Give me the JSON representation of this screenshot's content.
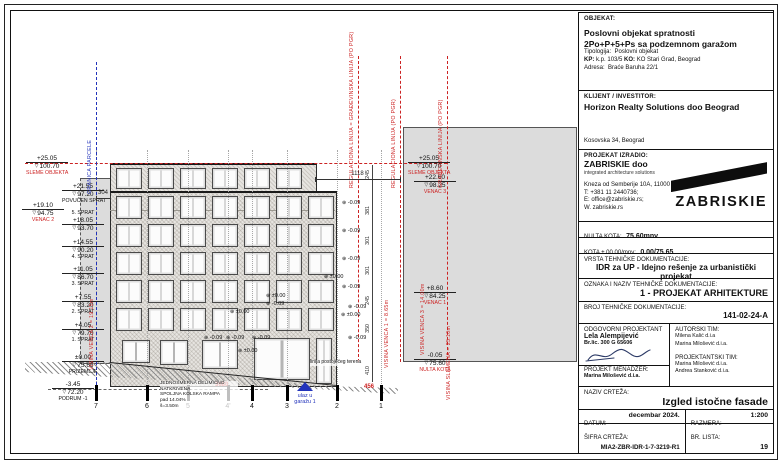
{
  "titleblock": {
    "objekat_label": "OBJEKAT:",
    "objekat_line1": "Poslovni objekat spratnosti",
    "objekat_line2": "2Po+P+5+Ps sa podzemnom garažom",
    "tipologija_label": "Tipologija:",
    "tipologija": "Poslovni objekat",
    "kp_label": "KP:",
    "kp": "k.p. 103/5",
    "ko_label": "KO:",
    "ko": "KO Stari Grad, Beograd",
    "adresa_label": "Adresa:",
    "adresa": "Braće Baruha 22/1",
    "klijent_label": "KLIJENT / INVESTITOR:",
    "klijent_name": "Horizon Realty Solutions doo Beograd",
    "klijent_adresa": "Kosovska 34, Beograd",
    "izradio_label": "PROJEKAT IZRADIO:",
    "izradio_name": "ZABRISKIE doo",
    "izradio_tagline": "integrated architecture solutions",
    "izradio_adresa": "Kneza od Semberije 10A, 11000 Beograd",
    "izradio_tel": "T: +381 11 2440736;",
    "izradio_email": "E: office@zabriskie.rs;",
    "izradio_web": "W. zabriskie.rs",
    "logo_text": "ZABRISKIE",
    "nulta_kota_label": "NULTA KOTA:",
    "nulta_kota": "75.60mnv",
    "kota_label": "KOTA ± 00.00/mnv:",
    "kota": "0.00/75.65",
    "vrsta_label": "VRSTA TEHNIČKE DOKUMENTACIJE:",
    "vrsta": "IDR za UP - Idejno rešenje za urbanistički projekat",
    "oznaka_label": "OZNAKA I NAZIV TEHNIČKE DOKUMENTACIJE:",
    "oznaka": "1 - PROJEKAT ARHITEKTURE",
    "broj_label": "BROJ TEHNIČKE DOKUMENTACIJE:",
    "broj": "141-02-24-A",
    "odgovorni_label": "ODGOVORNI PROJEKTANT",
    "odgovorni_name": "Lela Alempijević",
    "odgovorni_lic": "Br.lic. 300 G 65606",
    "menadzer_label": "PROJEKT MENADŽER:",
    "menadzer_name": "Marina Milošević d.i.a.",
    "autorski_label": "AUTORSKI TIM:",
    "autorski": [
      "Milena Kalić d.i.a",
      "Marina Milošević d.i.a."
    ],
    "projektantski_label": "PROJEKTANTSKI TIM:",
    "projektantski": [
      "Marina Milošević d.i.a.",
      "Andrea Stanković d.i.a."
    ],
    "naziv_label": "NAZIV CRTEŽA:",
    "naziv": "Izgled istočne fasade",
    "datum_label": "DATUM:",
    "datum": "decembar 2024.",
    "razmera_label": "RAZMERA:",
    "razmera": "1:200",
    "sifra_label": "ŠIFRA CRTEŽA:",
    "sifra": "MIA2-ZBR-IDR-1-7-3219-R1",
    "lista_label": "BR. LISTA:",
    "lista": "19"
  },
  "drawing": {
    "colors": {
      "red": "#cc2222",
      "blue": "#2233bb"
    },
    "markers": [
      {
        "elev": "+25.05",
        "kota": "100.70",
        "label": "SLEME OBJEKTA",
        "red": true,
        "x": 16,
        "y": 153
      },
      {
        "elev": "+21.55",
        "kota": "97.20",
        "label": "POVUČEN SPRAT",
        "red": false,
        "x": 52,
        "y": 181
      },
      {
        "elev": "+19.10",
        "kota": "94.75",
        "label": "VENAC 2",
        "red": true,
        "x": 12,
        "y": 200
      },
      {
        "elev": "+18.05",
        "kota": "93.70",
        "label": "5. SPRAT",
        "red": false,
        "x": 52,
        "y": 209,
        "labelTop": true
      },
      {
        "elev": "+14.55",
        "kota": "90.20",
        "label": "4. SPRAT",
        "red": false,
        "x": 52,
        "y": 237
      },
      {
        "elev": "+11.05",
        "kota": "86.70",
        "label": "3. SPRAT",
        "red": false,
        "x": 52,
        "y": 264
      },
      {
        "elev": "+7.55",
        "kota": "83.20",
        "label": "2. SPRAT",
        "red": false,
        "x": 52,
        "y": 292
      },
      {
        "elev": "+4.05",
        "kota": "79.70",
        "label": "1. SPRAT",
        "red": false,
        "x": 52,
        "y": 320
      },
      {
        "elev": "±0.00",
        "kota": "75.65",
        "label": "PRIZEMLJE",
        "red": false,
        "x": 52,
        "y": 352
      },
      {
        "elev": "-3.45",
        "kota": "72.20",
        "label": "PODRUM -1",
        "red": false,
        "x": 42,
        "y": 379
      },
      {
        "elev": "+25.05",
        "kota": "100.70",
        "label": "SLEME OBJEKTA",
        "red": true,
        "x": 398,
        "y": 153
      },
      {
        "elev": "+22.60",
        "kota": "98.25",
        "label": "VENAC 3",
        "red": true,
        "x": 404,
        "y": 172
      },
      {
        "elev": "+8.60",
        "kota": "84.25",
        "label": "VENAC 1",
        "red": true,
        "x": 404,
        "y": 283
      },
      {
        "elev": "-0.05",
        "kota": "75.60",
        "label": "NULTA KOTA",
        "red": true,
        "x": 404,
        "y": 350
      }
    ],
    "boundaries": [
      {
        "text": "GRANICA PARCELE",
        "x": 86,
        "top": 52,
        "bottom": 380,
        "color": "#2233bb"
      },
      {
        "text": "REGULACIONA LINIJA = GRAĐEVINSKA LINIJA (PO PGR)",
        "x": 348,
        "top": 46,
        "bottom": 352,
        "color": "#cc2222"
      },
      {
        "text": "REGULACIONA LINIJA (PO PGR)",
        "x": 390,
        "top": 46,
        "bottom": 352,
        "color": "#cc2222"
      },
      {
        "text": "GRAĐEVINSKA LINIJA (PO PGR)",
        "x": 437,
        "top": 46,
        "bottom": 350,
        "color": "#cc2222"
      }
    ],
    "vtexts": [
      {
        "text": "VISINA VENCA 2 = 19.15m",
        "x": 79,
        "top": 238,
        "h": 122
      },
      {
        "text": "VISINA VENCA 1 = 8.65m",
        "x": 374,
        "top": 290,
        "h": 68
      },
      {
        "text": "VISINA VENCA 3 = 14.00m",
        "x": 410,
        "top": 215,
        "h": 130
      },
      {
        "text": "VISINA SLEMENA = 25.10m",
        "x": 436,
        "top": 245,
        "h": 145
      }
    ],
    "axes": [
      {
        "n": "7",
        "x": 86
      },
      {
        "n": "6",
        "x": 137
      },
      {
        "n": "5",
        "x": 178
      },
      {
        "n": "4'",
        "x": 218
      },
      {
        "n": "4",
        "x": 242
      },
      {
        "n": "3",
        "x": 277
      },
      {
        "n": "2",
        "x": 327
      },
      {
        "n": "1",
        "x": 371
      }
    ],
    "spots": [
      {
        "t": "-0.09",
        "x": 332,
        "y": 190
      },
      {
        "t": "-0.09",
        "x": 332,
        "y": 218
      },
      {
        "t": "-0.09",
        "x": 332,
        "y": 246
      },
      {
        "t": "±0.00",
        "x": 314,
        "y": 264
      },
      {
        "t": "-0.09",
        "x": 332,
        "y": 274
      },
      {
        "t": "±0.00",
        "x": 256,
        "y": 283
      },
      {
        "t": "-0.09",
        "x": 256,
        "y": 291
      },
      {
        "t": "±0.00",
        "x": 220,
        "y": 299
      },
      {
        "t": "-0.09",
        "x": 194,
        "y": 325
      },
      {
        "t": "-0.09",
        "x": 216,
        "y": 325
      },
      {
        "t": "-0.09",
        "x": 242,
        "y": 325
      },
      {
        "t": "±0.00",
        "x": 228,
        "y": 338
      },
      {
        "t": "-0.09",
        "x": 338,
        "y": 294
      },
      {
        "t": "±0.00",
        "x": 331,
        "y": 302
      },
      {
        "t": "-0.09",
        "x": 338,
        "y": 325
      }
    ],
    "dims": {
      "top": {
        "v": "1118",
        "x1": 305,
        "x2": 390,
        "y": 169
      },
      "left": {
        "v": "304",
        "x1": 86,
        "x2": 100,
        "y": 188
      },
      "red1": {
        "v": "3680",
        "x": 205,
        "y": 372
      },
      "red2": {
        "v": "456",
        "x": 354,
        "y": 374
      },
      "chain_x": 362,
      "chain": [
        {
          "v": "245",
          "y": 160
        },
        {
          "v": "381",
          "y": 196
        },
        {
          "v": "301",
          "y": 226
        },
        {
          "v": "301",
          "y": 256
        },
        {
          "v": "245",
          "y": 286
        },
        {
          "v": "350",
          "y": 314
        },
        {
          "v": "410",
          "y": 356
        }
      ]
    },
    "sleme_line": {
      "y": 153,
      "x1": 15,
      "x2": 437
    },
    "podrum_line": {
      "y": 379,
      "x1": 38,
      "x2": 258
    },
    "ramp_note": [
      "JEDNOSMERNA DELIMIČNO NATKRIVENA",
      "SPOLJNA KOLSKA RAMPA",
      "pad 14.04%",
      "š=3.50m"
    ],
    "kiosk_lines": [
      "ulaz u",
      "garažu 1"
    ],
    "terrain_note": "linija postojećeg terena",
    "facade": {
      "setback_cols": [
        106,
        138,
        170,
        202,
        234,
        266
      ],
      "setback_win": {
        "y": 158,
        "w": 24,
        "h": 19
      },
      "cols": [
        106,
        138,
        170,
        202,
        234,
        266,
        298
      ],
      "win_w": 24,
      "rows": [
        {
          "y": 186,
          "h": 21
        },
        {
          "y": 214,
          "h": 21
        },
        {
          "y": 242,
          "h": 21
        },
        {
          "y": 270,
          "h": 21
        },
        {
          "y": 298,
          "h": 21
        }
      ],
      "ground": [
        {
          "x": 112,
          "y": 330,
          "w": 26,
          "h": 21
        },
        {
          "x": 150,
          "y": 330,
          "w": 26,
          "h": 23
        },
        {
          "x": 192,
          "y": 330,
          "w": 34,
          "h": 27
        },
        {
          "x": 244,
          "y": 328,
          "w": 54,
          "h": 40
        },
        {
          "x": 306,
          "y": 328,
          "w": 14,
          "h": 44
        }
      ]
    }
  }
}
